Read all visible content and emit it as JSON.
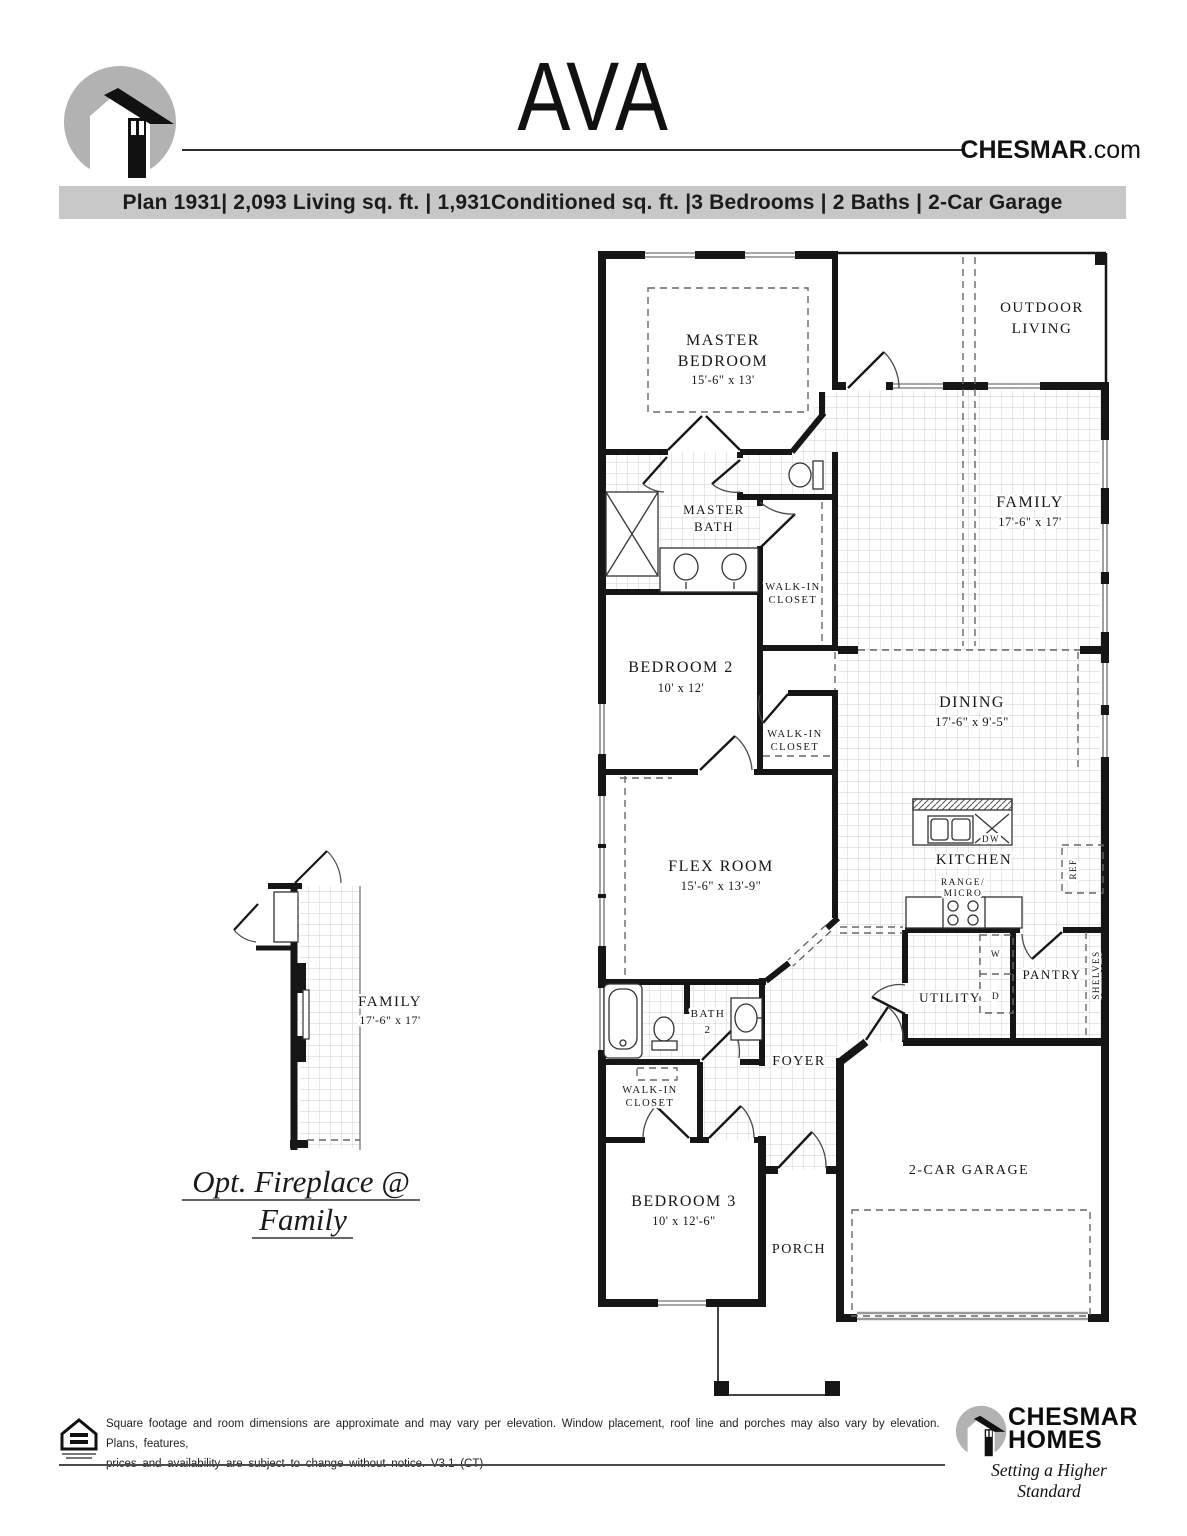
{
  "header": {
    "plan_name": "AVA",
    "website_bold": "CHESMAR",
    "website_rest": ".com",
    "banner": "Plan 1931| 2,093 Living sq. ft. | 1,931Conditioned sq. ft. |3 Bedrooms | 2 Baths | 2-Car Garage"
  },
  "plan": {
    "master_bedroom": {
      "line1": "MASTER",
      "line2": "BEDROOM",
      "dims": "15'-6\" x 13'"
    },
    "outdoor_living": {
      "line1": "OUTDOOR",
      "line2": "LIVING"
    },
    "family": {
      "name": "FAMILY",
      "dims": "17'-6\" x 17'"
    },
    "master_bath": {
      "line1": "MASTER",
      "line2": "BATH"
    },
    "walk_in_closet": {
      "line1": "WALK-IN",
      "line2": "CLOSET"
    },
    "bedroom_2": {
      "name": "BEDROOM 2",
      "dims": "10' x 12'"
    },
    "dining": {
      "name": "DINING",
      "dims": "17'-6\" x 9'-5\""
    },
    "flex_room": {
      "name": "FLEX ROOM",
      "dims": "15'-6\" x 13'-9\""
    },
    "kitchen": {
      "name": "KITCHEN"
    },
    "range_micro": {
      "line1": "RANGE/",
      "line2": "MICRO"
    },
    "dw": "DW",
    "ref": "REF",
    "utility": {
      "name": "UTILITY"
    },
    "washer": "W",
    "dryer": "D",
    "pantry": {
      "name": "PANTRY"
    },
    "shelves": "SHELVES",
    "bath_2": {
      "line1": "BATH",
      "line2": "2"
    },
    "foyer": {
      "name": "FOYER"
    },
    "bedroom_3": {
      "name": "BEDROOM 3",
      "dims": "10' x 12'-6\""
    },
    "porch": {
      "name": "PORCH"
    },
    "garage": {
      "name": "2-CAR GARAGE"
    }
  },
  "option_detail": {
    "family_name": "FAMILY",
    "family_dims": "17'-6\" x 17'",
    "caption_line1": "Opt. Fireplace @",
    "caption_line2": "Family"
  },
  "footer": {
    "disclaimer_line1": "Square footage and room dimensions are approximate and may vary per elevation. Window placement, roof line and porches may also vary by elevation. Plans, features,",
    "disclaimer_line2": "prices and availability are subject to change without notice. V3.1 (CT)",
    "brand_line1": "CHESMAR",
    "brand_line2": "HOMES",
    "tagline": "Setting a Higher Standard"
  }
}
